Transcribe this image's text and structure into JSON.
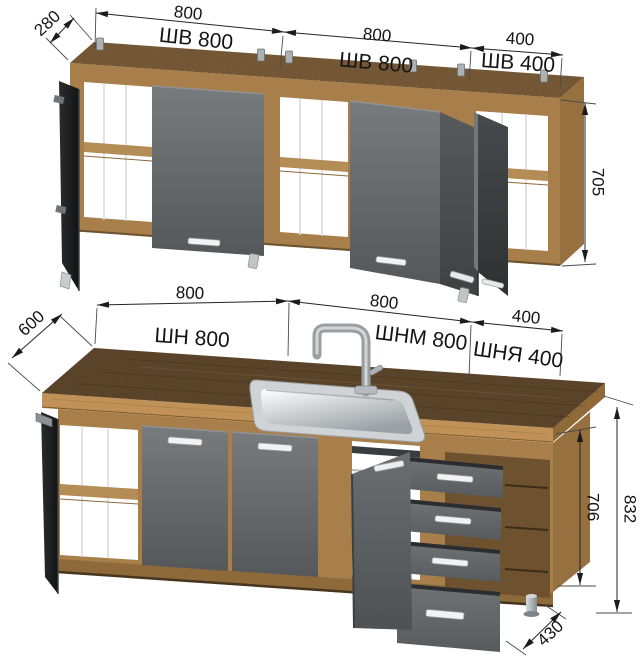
{
  "figure": {
    "kind": "kitchen cabinet set — dimensional technical drawing",
    "units_note": "",
    "rows": [
      "wall cabinets",
      "base cabinets"
    ]
  },
  "wall_row": {
    "depth": "280",
    "w1": "800",
    "w2": "800",
    "w3": "400",
    "height": "705",
    "c1": "ШВ 800",
    "c2": "ШВ 800",
    "c3": "ШВ 400"
  },
  "base_row": {
    "depth": "600",
    "w1": "800",
    "w2": "800",
    "w3": "400",
    "height": "706",
    "total_height": "832",
    "bottom_depth": "430",
    "c1": "ШН 800",
    "c2": "ШНМ 800",
    "c3": "ШНЯ 400"
  },
  "colors": {
    "wood_front": "#a87f4a",
    "wood_top": "#7a5c38",
    "wood_side": "#96713f",
    "counter_top": "#5a432a",
    "counter_edge": "#c09257",
    "door_gray": "#66696b",
    "door_dark": "#202224",
    "handle": "#f2f2f2",
    "dim_line": "#232323",
    "text": "#141414"
  }
}
